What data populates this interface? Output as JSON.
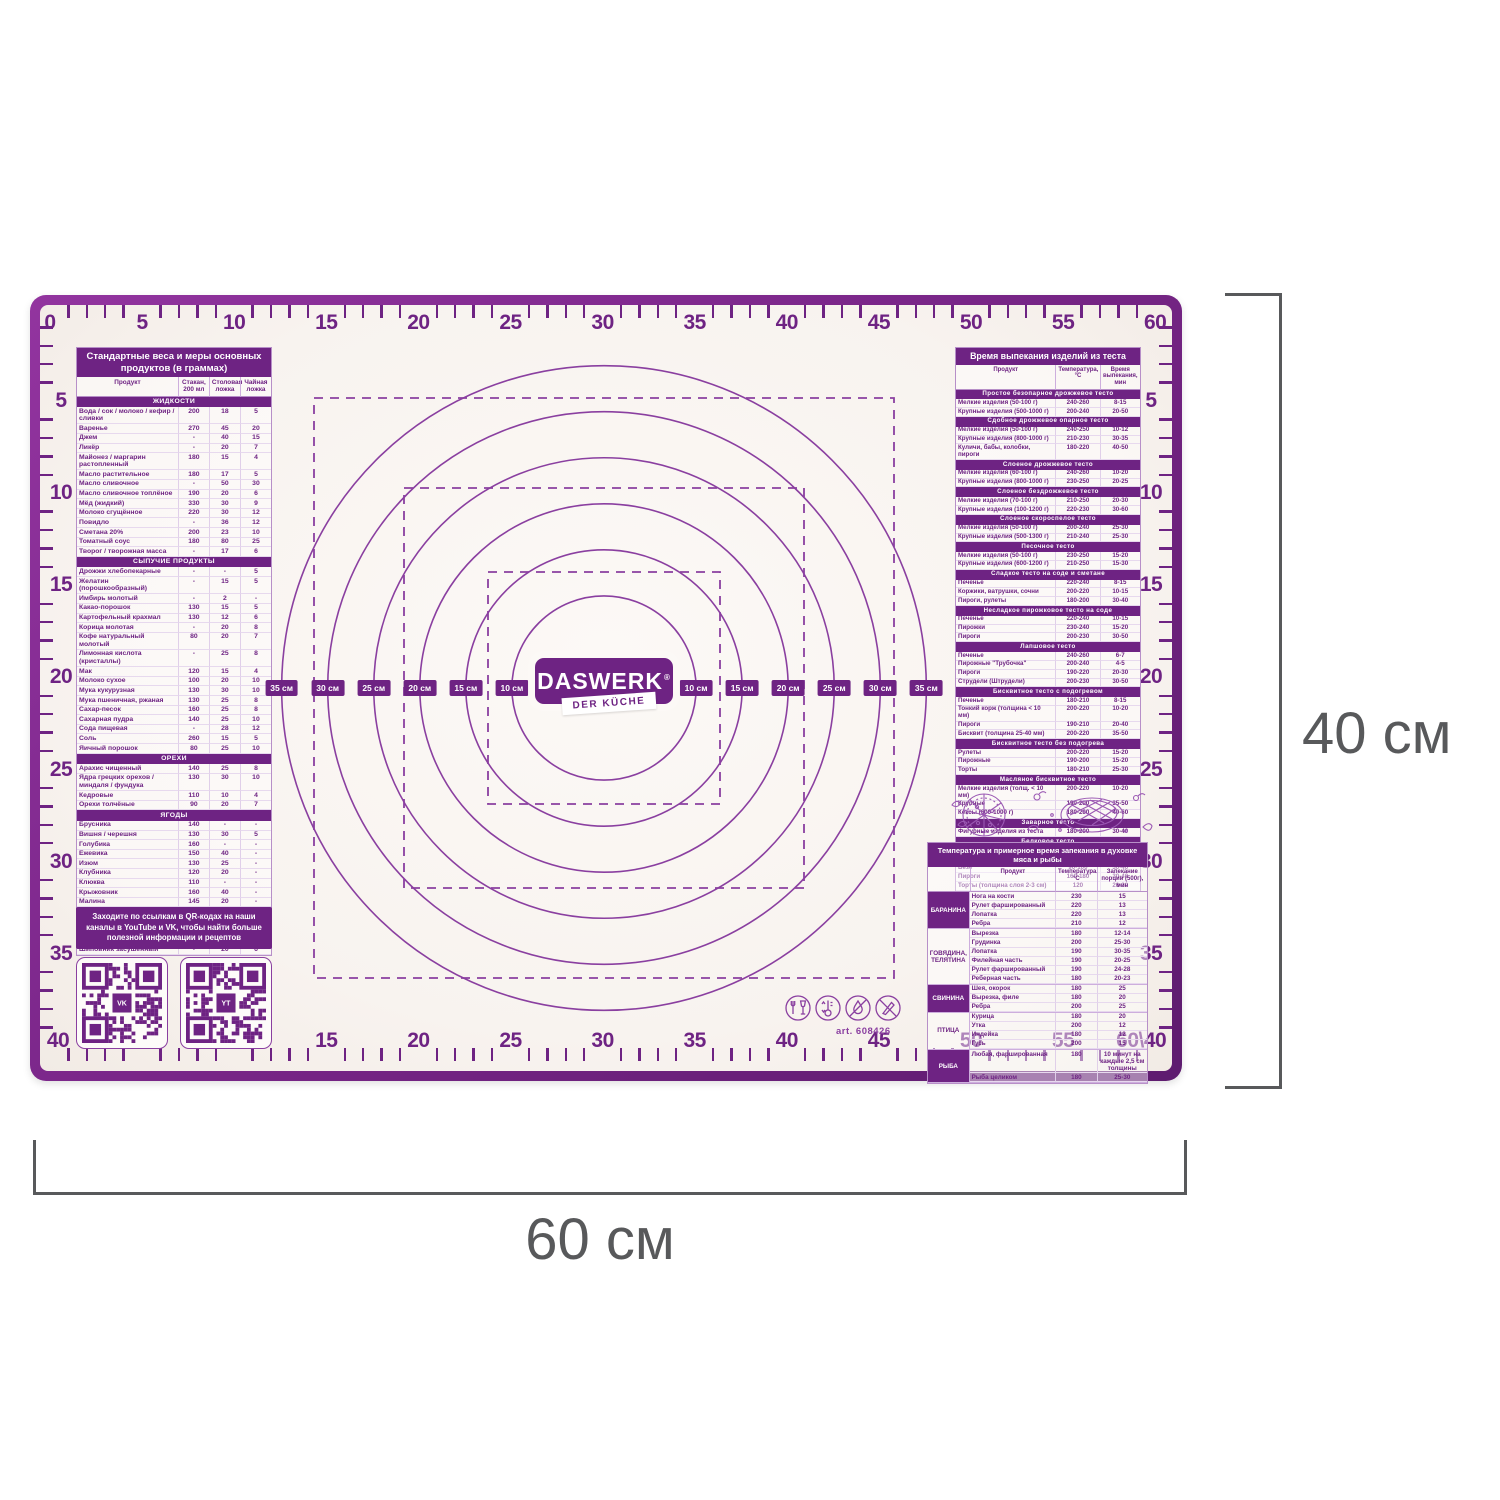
{
  "dimensions": {
    "height_label": "40 см",
    "width_label": "60 см"
  },
  "logo": {
    "brand": "DASWERK",
    "reg": "®",
    "tagline": "DER KÜCHE"
  },
  "colors": {
    "purple": "#6e2383",
    "purple_light": "#8a3fa0",
    "dim_gray": "#58595b",
    "surface": "#faf6f2"
  },
  "rulers": {
    "top": [
      "0",
      "5",
      "10",
      "15",
      "20",
      "25",
      "30",
      "35",
      "40",
      "45",
      "50",
      "55",
      "60"
    ],
    "bottom": [
      "40",
      "5",
      "10",
      "15",
      "20",
      "25",
      "30",
      "35",
      "40",
      "45",
      "50",
      "55",
      "60\\40"
    ],
    "left": [
      "5",
      "10",
      "15",
      "20",
      "25",
      "30",
      "35"
    ],
    "right": [
      "5",
      "10",
      "15",
      "20",
      "25",
      "30",
      "35"
    ]
  },
  "circles": {
    "diameters_cm_left": [
      35,
      30,
      25,
      20,
      15,
      10
    ],
    "labels_left": [
      "35 см",
      "30 см",
      "25 см",
      "20 см",
      "15 см",
      "10 см"
    ],
    "diameters_cm_right": [
      10,
      15,
      20,
      25,
      30,
      35
    ],
    "labels_right": [
      "10 см",
      "15 см",
      "20 см",
      "25 см",
      "30 см",
      "35 см"
    ]
  },
  "weights_table": {
    "title": "Стандартные веса и меры основных продуктов (в граммах)",
    "columns": [
      "Продукт",
      "Стакан, 200 мл",
      "Столовая ложка",
      "Чайная ложка"
    ],
    "rows": [
      [
        "ЖИДКОСТИ"
      ],
      [
        "Вода / сок / молоко / кефир / сливки",
        "200",
        "18",
        "5"
      ],
      [
        "Варенье",
        "270",
        "45",
        "20"
      ],
      [
        "Джем",
        "-",
        "40",
        "15"
      ],
      [
        "Ликёр",
        "-",
        "20",
        "7"
      ],
      [
        "Майонез / маргарин растопленный",
        "180",
        "15",
        "4"
      ],
      [
        "Масло растительное",
        "180",
        "17",
        "5"
      ],
      [
        "Масло сливочное",
        "-",
        "50",
        "30"
      ],
      [
        "Масло сливочное топлёное",
        "190",
        "20",
        "6"
      ],
      [
        "Мёд (жидкий)",
        "330",
        "30",
        "9"
      ],
      [
        "Молоко сгущённое",
        "220",
        "30",
        "12"
      ],
      [
        "Повидло",
        "-",
        "36",
        "12"
      ],
      [
        "Сметана 20%",
        "200",
        "23",
        "10"
      ],
      [
        "Томатный соус",
        "180",
        "80",
        "25"
      ],
      [
        "Творог / творожная масса",
        "-",
        "17",
        "6"
      ],
      [
        "СЫПУЧИЕ ПРОДУКТЫ"
      ],
      [
        "Дрожжи хлебопекарные",
        "-",
        "-",
        "5"
      ],
      [
        "Желатин (порошкообразный)",
        "-",
        "15",
        "5"
      ],
      [
        "Имбирь молотый",
        "-",
        "2",
        "-"
      ],
      [
        "Какао-порошок",
        "130",
        "15",
        "5"
      ],
      [
        "Картофельный крахмал",
        "130",
        "12",
        "6"
      ],
      [
        "Корица молотая",
        "-",
        "20",
        "8"
      ],
      [
        "Кофе натуральный молотый",
        "80",
        "20",
        "7"
      ],
      [
        "Лимонная кислота (кристаллы)",
        "-",
        "25",
        "8"
      ],
      [
        "Мак",
        "120",
        "15",
        "4"
      ],
      [
        "Молоко сухое",
        "100",
        "20",
        "10"
      ],
      [
        "Мука кукурузная",
        "130",
        "30",
        "10"
      ],
      [
        "Мука пшеничная, ржаная",
        "130",
        "25",
        "8"
      ],
      [
        "Сахар-песок",
        "160",
        "25",
        "8"
      ],
      [
        "Сахарная пудра",
        "140",
        "25",
        "10"
      ],
      [
        "Сода пищевая",
        "-",
        "28",
        "12"
      ],
      [
        "Соль",
        "260",
        "15",
        "5"
      ],
      [
        "Яичный порошок",
        "80",
        "25",
        "10"
      ],
      [
        "ОРЕХИ"
      ],
      [
        "Арахис чищенный",
        "140",
        "25",
        "8"
      ],
      [
        "Ядра грецких орехов / миндаля / фундука",
        "130",
        "30",
        "10"
      ],
      [
        "Кедровые",
        "110",
        "10",
        "4"
      ],
      [
        "Орехи толчёные",
        "90",
        "20",
        "7"
      ],
      [
        "ЯГОДЫ"
      ],
      [
        "Брусника",
        "140",
        "-",
        "-"
      ],
      [
        "Вишня / черешня",
        "130",
        "30",
        "5"
      ],
      [
        "Голубика",
        "160",
        "-",
        "-"
      ],
      [
        "Ежевика",
        "150",
        "40",
        "-"
      ],
      [
        "Изюм",
        "130",
        "25",
        "-"
      ],
      [
        "Клубника",
        "120",
        "20",
        "-"
      ],
      [
        "Клюква",
        "110",
        "-",
        "-"
      ],
      [
        "Крыжовник",
        "160",
        "40",
        "-"
      ],
      [
        "Малина",
        "145",
        "20",
        "-"
      ],
      [
        "Смородина красная / белая",
        "140",
        "35",
        "-"
      ],
      [
        "Смородина чёрная",
        "125",
        "30",
        "-"
      ],
      [
        "Черника",
        "160",
        "-",
        "-"
      ],
      [
        "Шелковица",
        "135",
        "40",
        "-"
      ],
      [
        "Шиповник засушенный",
        "-",
        "20",
        "6"
      ]
    ]
  },
  "baking_table": {
    "title": "Время выпекания изделий из теста",
    "columns": [
      "Продукт",
      "Температура, °С",
      "Время выпекания, мин"
    ],
    "rows": [
      [
        "Простое безопарное дрожжевое тесто"
      ],
      [
        "Мелкие изделия (50-100 г)",
        "240-260",
        "8-15"
      ],
      [
        "Крупные изделия (500-1000 г)",
        "200-240",
        "20-50"
      ],
      [
        "Сдобное дрожжевое опарное тесто"
      ],
      [
        "Мелкие изделия (50-100 г)",
        "240-250",
        "10-12"
      ],
      [
        "Крупные изделия (800-1000 г)",
        "210-230",
        "30-35"
      ],
      [
        "Куличи, бабы, колобки, пироги",
        "180-220",
        "40-50"
      ],
      [
        "Слоеное дрожжевое тесто"
      ],
      [
        "Мелкие изделия (60-100 г)",
        "240-260",
        "10-20"
      ],
      [
        "Крупные изделия (800-1000 г)",
        "230-250",
        "20-25"
      ],
      [
        "Слоеное бездрожжевое тесто"
      ],
      [
        "Мелкие изделия (70-100 г)",
        "210-250",
        "20-30"
      ],
      [
        "Крупные изделия (100-1200 г)",
        "220-230",
        "30-60"
      ],
      [
        "Слоеное скороспелое тесто"
      ],
      [
        "Мелкие изделия (50-100 г)",
        "200-240",
        "25-30"
      ],
      [
        "Крупные изделия (500-1300 г)",
        "210-240",
        "25-30"
      ],
      [
        "Песочное тесто"
      ],
      [
        "Мелкие изделия (50-100 г)",
        "230-250",
        "15-20"
      ],
      [
        "Крупные изделия (600-1200 г)",
        "210-250",
        "15-30"
      ],
      [
        "Сладкое тесто на соде и сметане"
      ],
      [
        "Печенье",
        "220-240",
        "8-15"
      ],
      [
        "Коржики, ватрушки, сочни",
        "200-220",
        "10-15"
      ],
      [
        "Пироги, рулеты",
        "180-200",
        "30-40"
      ],
      [
        "Несладкое пирожковое тесто на соде"
      ],
      [
        "Печенье",
        "220-240",
        "10-15"
      ],
      [
        "Пирожки",
        "230-240",
        "15-20"
      ],
      [
        "Пироги",
        "200-230",
        "30-50"
      ],
      [
        "Лапшовое тесто"
      ],
      [
        "Печенье",
        "240-260",
        "6-7"
      ],
      [
        "Пирожные \"Трубочка\"",
        "200-240",
        "4-5"
      ],
      [
        "Пироги",
        "190-220",
        "20-30"
      ],
      [
        "Струдели (Штрудели)",
        "200-230",
        "30-50"
      ],
      [
        "Бисквитное тесто с подогревом"
      ],
      [
        "Печенье",
        "180-210",
        "8-15"
      ],
      [
        "Тонкий корж (толщина < 10 мм)",
        "200-220",
        "10-20"
      ],
      [
        "Пироги",
        "190-210",
        "20-40"
      ],
      [
        "Бисквит (толщина 25-40 мм)",
        "200-220",
        "35-50"
      ],
      [
        "Бисквитное тесто без подогрева"
      ],
      [
        "Рулеты",
        "200-220",
        "15-20"
      ],
      [
        "Пирожные",
        "190-200",
        "15-20"
      ],
      [
        "Торты",
        "180-210",
        "25-30"
      ],
      [
        "Масляное бисквитное тесто"
      ],
      [
        "Мелкие изделия (толщ. < 10 мм)",
        "200-220",
        "10-20"
      ],
      [
        "Крупные",
        "190-200",
        "35-50"
      ],
      [
        "Кексы (600-1000 г)",
        "180-200",
        "40-60"
      ],
      [
        "Заварное тесто"
      ],
      [
        "Фигурные изделия из теста",
        "180-200",
        "30-40"
      ],
      [
        "Белковое тесто"
      ],
      [
        "Печенье",
        "130-150",
        "10-15"
      ],
      [
        "Меренги",
        "110-120",
        "25-30"
      ],
      [
        "Безе",
        "90-100",
        "30-40"
      ],
      [
        "Пироги",
        "160-180",
        "30-40"
      ],
      [
        "Торты (толщина слоя 2-3 см)",
        "120",
        "20-30"
      ]
    ]
  },
  "roasting_table": {
    "title": "Температура и примерное время запекания в духовке мяса и рыбы",
    "columns": [
      "Продукт",
      "Температура, °С",
      "Запекание порции (500г), мин"
    ],
    "groups": [
      {
        "name": "БАРАНИНА",
        "filled": true,
        "rows": [
          [
            "Нога на кости",
            "230",
            "15"
          ],
          [
            "Рулет фаршированный",
            "220",
            "13"
          ],
          [
            "Лопатка",
            "220",
            "13"
          ],
          [
            "Ребра",
            "210",
            "12"
          ]
        ]
      },
      {
        "name": "ГОВЯДИНА, ТЕЛЯТИНА",
        "filled": false,
        "rows": [
          [
            "Вырезка",
            "180",
            "12-14"
          ],
          [
            "Грудинка",
            "200",
            "25-30"
          ],
          [
            "Лопатка",
            "190",
            "30-35"
          ],
          [
            "Филейная часть",
            "190",
            "20-25"
          ],
          [
            "Рулет фаршированный",
            "190",
            "24-28"
          ],
          [
            "Реберная часть",
            "180",
            "20-23"
          ]
        ]
      },
      {
        "name": "СВИНИНА",
        "filled": true,
        "rows": [
          [
            "Шея, окорок",
            "180",
            "25"
          ],
          [
            "Вырезка, филе",
            "180",
            "20"
          ],
          [
            "Ребра",
            "200",
            "25"
          ]
        ]
      },
      {
        "name": "ПТИЦА",
        "filled": false,
        "rows": [
          [
            "Курица",
            "180",
            "20"
          ],
          [
            "Утка",
            "200",
            "12"
          ],
          [
            "Индейка",
            "180",
            "12"
          ],
          [
            "Гусь",
            "200",
            "15"
          ]
        ]
      },
      {
        "name": "РЫБА",
        "filled": true,
        "rows": [
          [
            "Любая, фаршированная",
            "180",
            "10 минут на каждые 2,5 см толщины"
          ],
          [
            "Рыба целиком",
            "180",
            "25-30"
          ]
        ]
      }
    ]
  },
  "qr_block": {
    "text": "Заходите по ссылкам в QR-кодах на наши каналы в YouTube и VK, чтобы найти больше полезной информации и рецептов",
    "codes": [
      {
        "name": "vk-qr-code",
        "center": "VK"
      },
      {
        "name": "youtube-qr-code",
        "center": "YT"
      }
    ]
  },
  "footer_icons": {
    "art_label": "art. 608426",
    "icons": [
      "glass-fork-icon",
      "thermometer-icon",
      "no-open-flame-icon",
      "no-knife-icon"
    ]
  }
}
